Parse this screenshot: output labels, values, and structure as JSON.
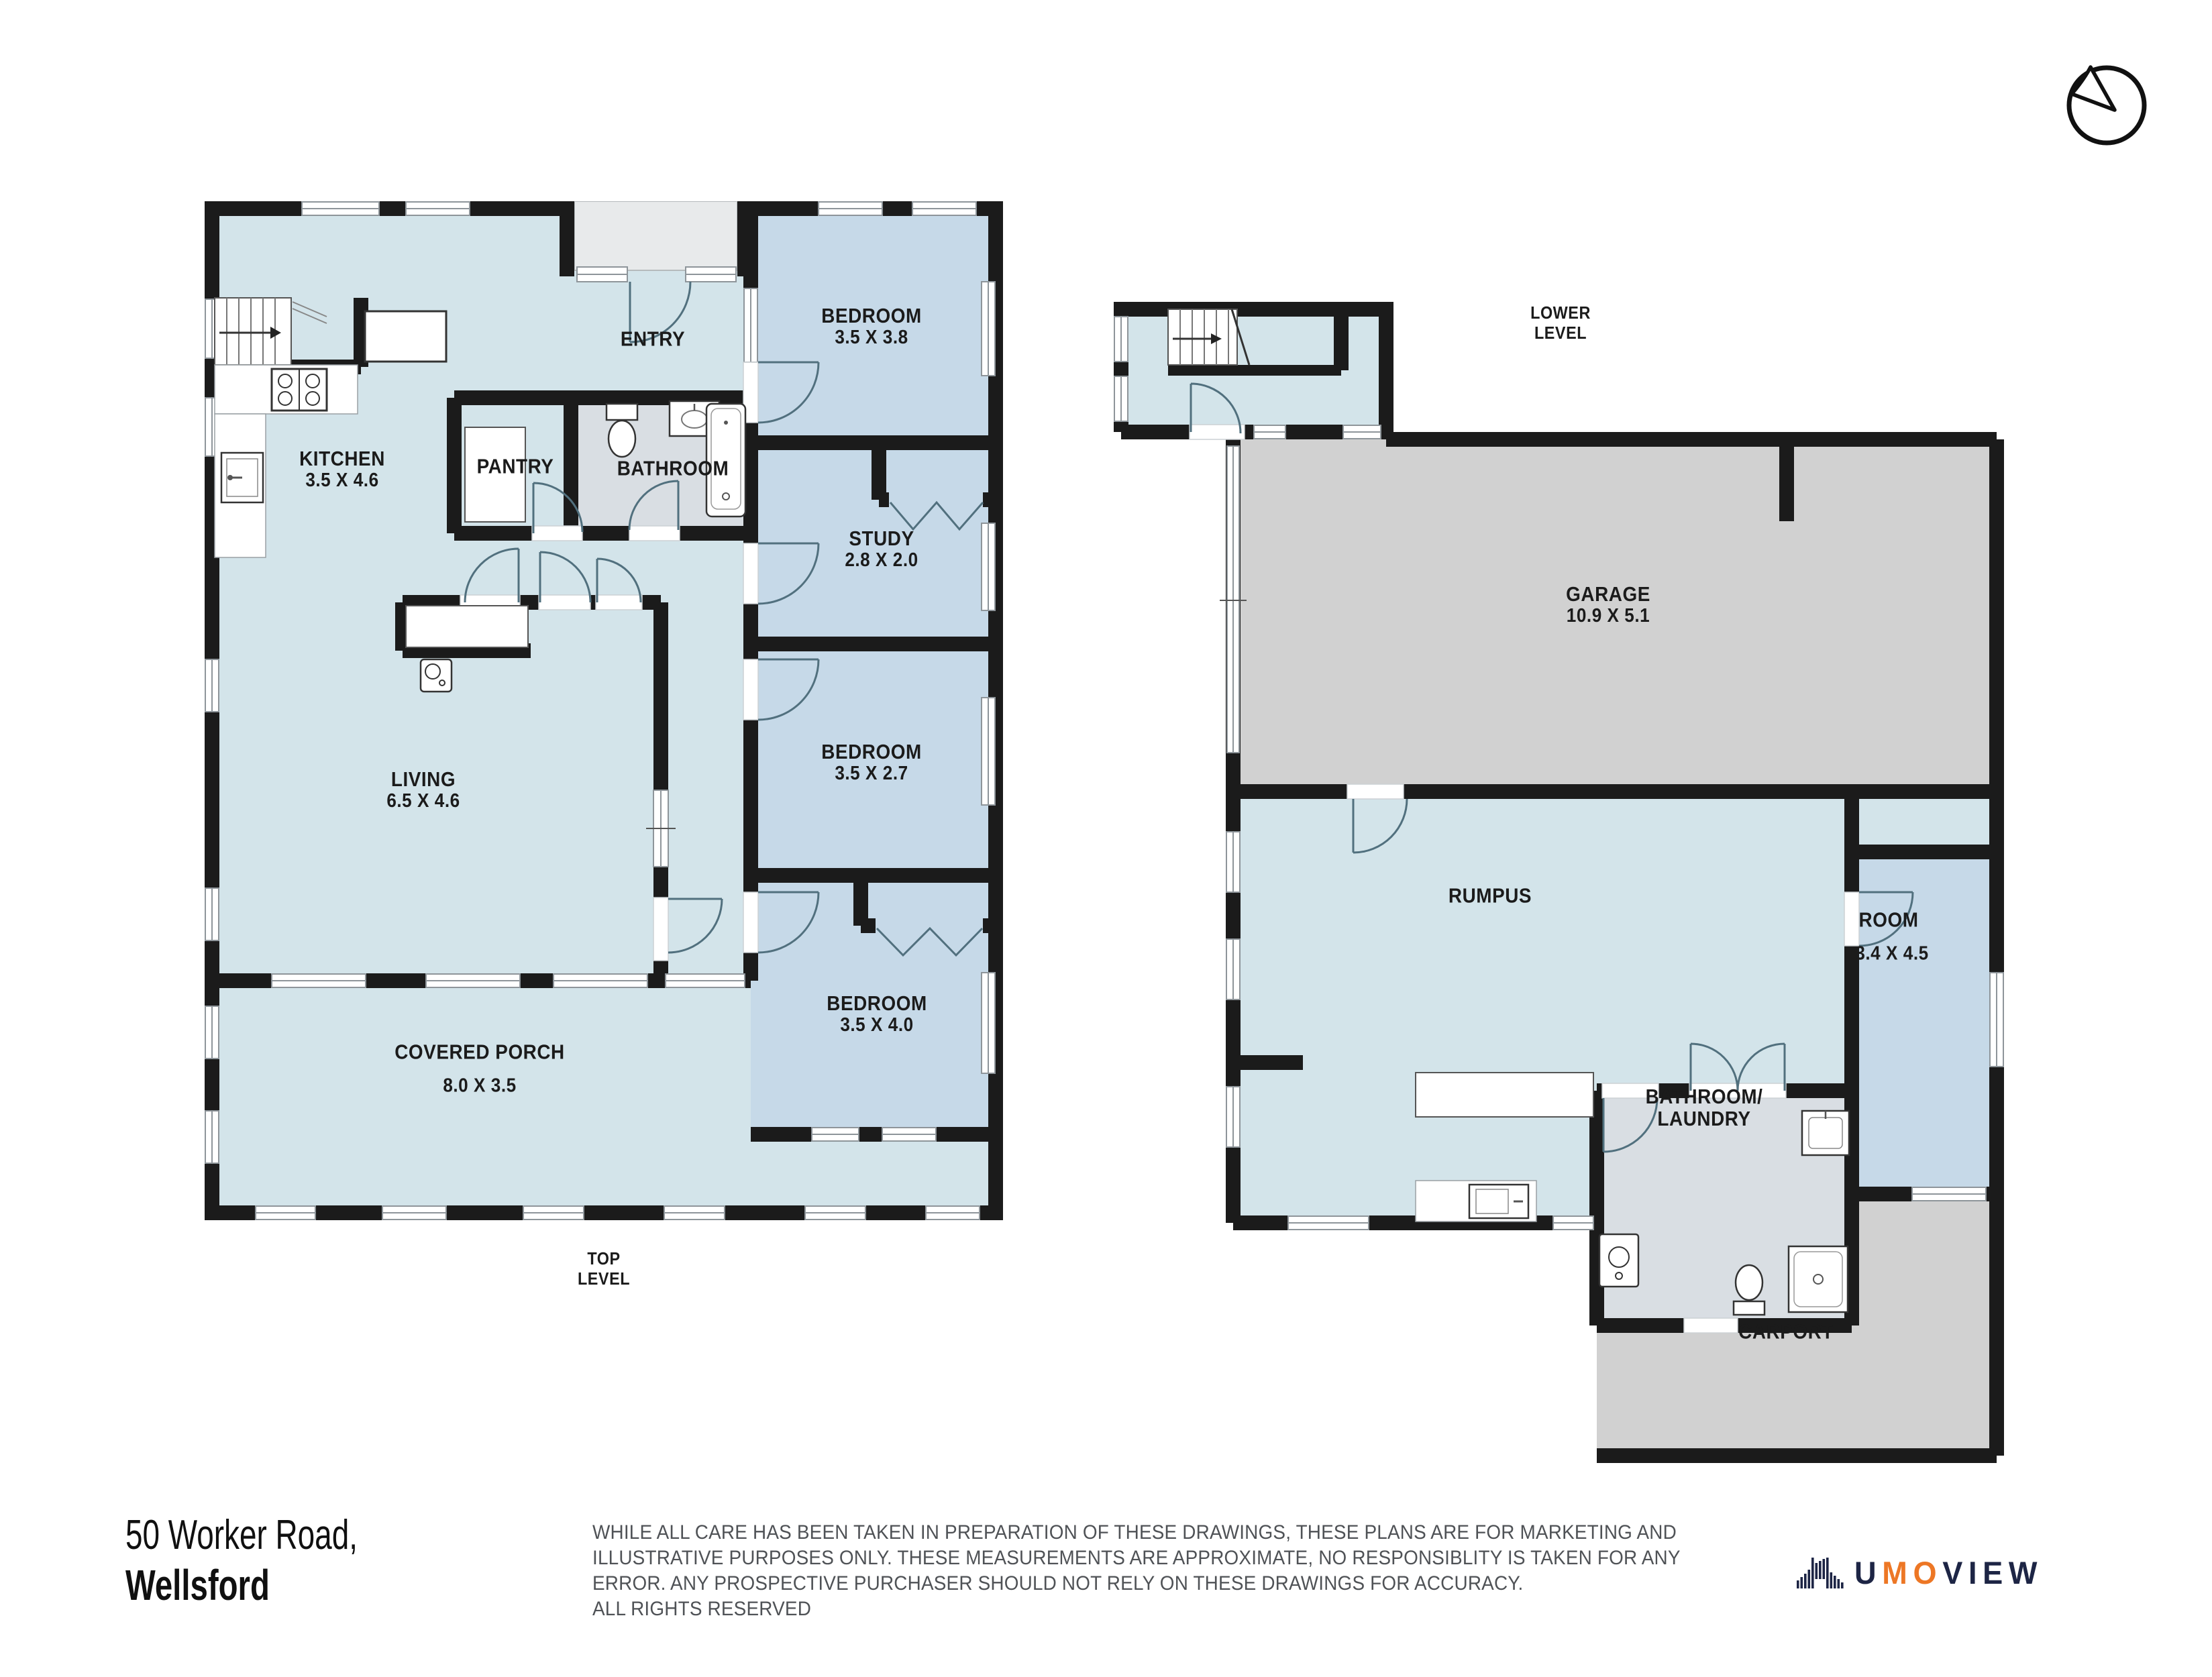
{
  "plans": {
    "top_level": {
      "title": [
        "TOP",
        "LEVEL"
      ],
      "rooms": {
        "entry": {
          "name": "ENTRY"
        },
        "bedroom1": {
          "name": "BEDROOM",
          "dims": "3.5 X 3.8"
        },
        "kitchen": {
          "name": "KITCHEN",
          "dims": "3.5 X 4.6"
        },
        "pantry": {
          "name": "PANTRY"
        },
        "bathroom": {
          "name": "BATHROOM"
        },
        "study": {
          "name": "STUDY",
          "dims": "2.8 X 2.0"
        },
        "bedroom2": {
          "name": "BEDROOM",
          "dims": "3.5 X 2.7"
        },
        "living": {
          "name": "LIVING",
          "dims": "6.5 X 4.6"
        },
        "bedroom3": {
          "name": "BEDROOM",
          "dims": "3.5 X 4.0"
        },
        "covered_porch": {
          "name": "COVERED PORCH",
          "dims": "8.0 X 3.5"
        }
      }
    },
    "lower_level": {
      "title": [
        "LOWER",
        "LEVEL"
      ],
      "rooms": {
        "garage": {
          "name": "GARAGE",
          "dims": "10.9 X 5.1"
        },
        "rumpus": {
          "name": "RUMPUS"
        },
        "room": {
          "name": "ROOM",
          "dims": "3.4 X 4.5"
        },
        "bathroom_laundry": {
          "name": "BATHROOM/",
          "name2": "LAUNDRY"
        },
        "carport": {
          "name": "CARPORT"
        }
      }
    }
  },
  "footer": {
    "address_line1": "50 Worker Road,",
    "address_line2": "Wellsford",
    "disclaimer_lines": [
      "WHILE ALL CARE HAS BEEN TAKEN IN PREPARATION OF THESE DRAWINGS, THESE PLANS ARE FOR MARKETING AND",
      "ILLUSTRATIVE PURPOSES ONLY. THESE MEASUREMENTS ARE APPROXIMATE, NO RESPONSIBLITY IS TAKEN FOR ANY",
      "ERROR. ANY PROSPECTIVE PURCHASER SHOULD NOT RELY ON THESE DRAWINGS FOR ACCURACY.",
      "ALL RIGHTS RESERVED"
    ],
    "logo": {
      "part1": "U",
      "part2": "MO",
      "part3": "VIEW"
    }
  },
  "colors": {
    "wall": "#1b1b1b",
    "floor_main": "#d3e4ea",
    "floor_room": "#c6d9e8",
    "floor_bath": "#d9dee3",
    "floor_garage": "#d1d1d1",
    "floor_porch": "#e8eaeb",
    "logo_navy": "#1d2545",
    "logo_orange": "#ed7725"
  }
}
